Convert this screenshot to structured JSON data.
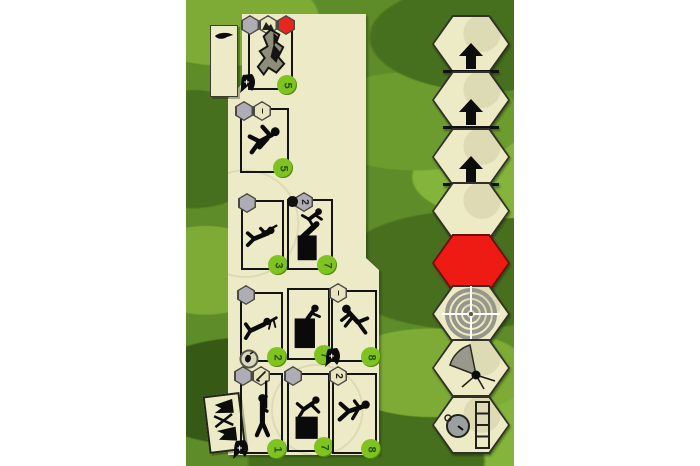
{
  "palette": {
    "camo_base": "#5e8c28",
    "camo_light": "#7dab35",
    "camo_lighter": "#84b43b",
    "camo_dark": "#46701d",
    "camo_darker": "#365a16",
    "panel": "#edeac7",
    "card_border": "#141414",
    "value_circle_green": "#7ec31f",
    "value_text_green": "#27520a",
    "red_hex": "#ee1a14",
    "badge_gray": "#aeadb5",
    "hex_fill": "#edeac6",
    "hex_outline": "#31312a"
  },
  "cards": [
    {
      "name": "terrain-rocks-card",
      "value": "5",
      "badges": [
        "gray",
        "terrain",
        "red"
      ],
      "corner_icon": "helmet-plus-icon",
      "art": "rock-formation"
    },
    {
      "name": "crawling-soldier-card",
      "value": "5",
      "badges": [
        "gray",
        "minus"
      ],
      "corner_icon": "",
      "art": "crawling-soldier"
    },
    {
      "name": "prone-sniper-card",
      "value": "3",
      "badges": [
        "gray"
      ],
      "corner_icon": "",
      "art": "prone-sniper"
    },
    {
      "name": "mortar-card",
      "value": "7",
      "badges": [
        "bomb-two"
      ],
      "corner_icon": "",
      "art": "mortar-and-falling-soldier"
    },
    {
      "name": "machine-gunner-card",
      "value": "2",
      "badges": [
        "gray"
      ],
      "corner_icon": "grenade-circle-icon",
      "art": "prone-machine-gunner"
    },
    {
      "name": "soldier-behind-crate-card",
      "value": "7",
      "badges": [],
      "corner_icon": "",
      "art": "soldier-behind-crate"
    },
    {
      "name": "falling-soldier-card",
      "value": "8",
      "badges": [
        "minus"
      ],
      "corner_icon": "helmet-plus-icon",
      "art": "falling-soldier"
    },
    {
      "name": "standing-rifleman-card",
      "value": "1",
      "badges": [
        "gray",
        "rifle"
      ],
      "corner_icon": "helmet-plus-icon",
      "art": "standing-rifleman"
    },
    {
      "name": "climbing-soldier-card",
      "value": "7",
      "badges": [
        "gray"
      ],
      "corner_icon": "",
      "art": "climbing-soldier"
    },
    {
      "name": "walking-soldier-card",
      "value": "8",
      "badges": [
        "two"
      ],
      "corner_icon": "",
      "art": "walking-soldier"
    }
  ],
  "badge_glyphs": {
    "minus": "–",
    "two": "2"
  },
  "hex_track": [
    {
      "name": "advance-hex-1",
      "icon": "up-arrow-icon"
    },
    {
      "name": "advance-hex-2",
      "icon": "up-arrow-icon"
    },
    {
      "name": "advance-hex-3",
      "icon": "up-arrow-icon"
    },
    {
      "name": "blank-hex",
      "icon": "none"
    },
    {
      "name": "red-hex",
      "icon": "none"
    },
    {
      "name": "target-hex",
      "icon": "crosshair-target-icon"
    },
    {
      "name": "arc-hex",
      "icon": "firing-arc-icon"
    },
    {
      "name": "timer-hex",
      "icon": "stopwatch-track-icon"
    }
  ],
  "side_items": {
    "top_card_icon": "aircraft-silhouette-icon",
    "bottom_card_icon": "crossed-flags-icon"
  }
}
